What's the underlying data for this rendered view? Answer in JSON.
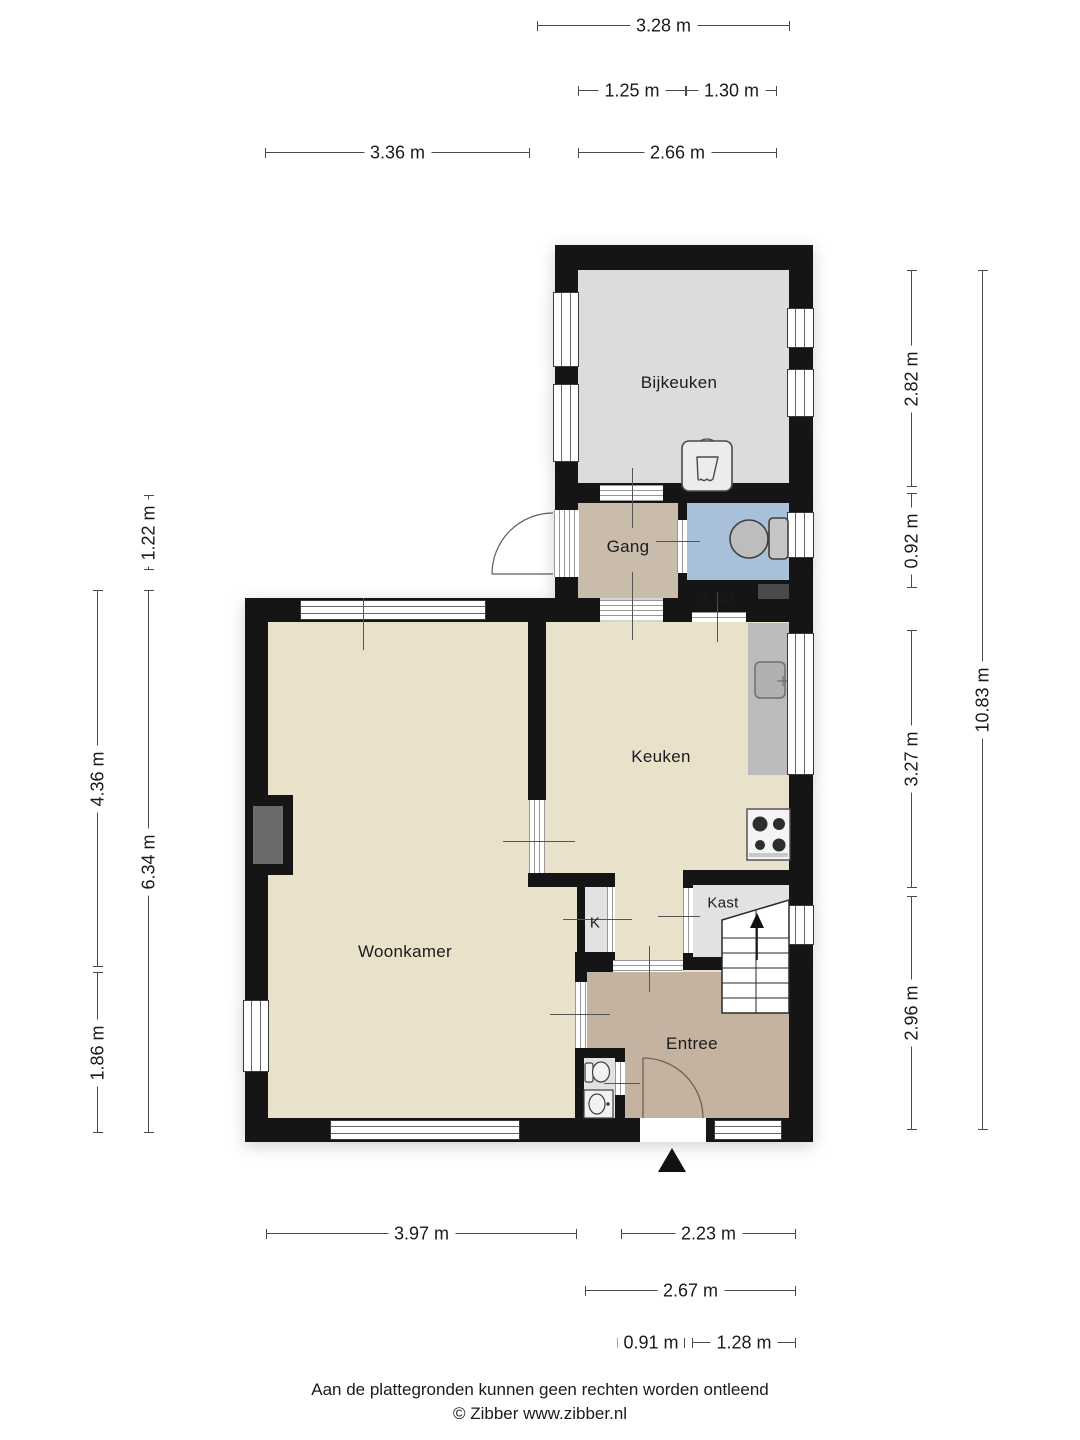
{
  "rooms": {
    "bijkeuken": "Bijkeuken",
    "gang": "Gang",
    "hall_closet": "Kast",
    "keuken": "Keuken",
    "woonkamer": "Woonkamer",
    "small_closet": "K",
    "stairs_closet": "Kast",
    "entree": "Entree"
  },
  "dimensions": {
    "top": [
      "3.28 m",
      "1.25 m",
      "1.30 m",
      "3.36 m",
      "2.66 m"
    ],
    "left": [
      "1.22 m",
      "4.36 m",
      "6.34 m",
      "1.86 m"
    ],
    "right": [
      "2.82 m",
      "0.92 m",
      "3.27 m",
      "2.96 m",
      "10.83 m"
    ],
    "bottom": [
      "3.97 m",
      "2.23 m",
      "2.67 m",
      "0.91 m",
      "1.28 m"
    ]
  },
  "footer": {
    "disclaimer": "Aan de plattegronden kunnen geen rechten worden ontleend",
    "credit": "© Zibber www.zibber.nl"
  },
  "colors": {
    "wall": "#151515",
    "bijkeuken_floor": "#dcdcdc",
    "gang_floor": "#cabcaa",
    "toilet_floor": "#a9c0da",
    "living_kitchen_floor": "#e9e1ca",
    "entree_floor": "#c4b3a1",
    "closet_floor": "#e2e2e2",
    "counter": "#bcbcbc",
    "shaft": "#4a4a4a",
    "chimney": "#6b6b6b",
    "dimension_line": "#4a4a4a"
  },
  "icons": {
    "toilet": "toilet-icon",
    "washbasin": "washbasin-icon",
    "utility_sink": "utility-sink-icon",
    "kitchen_sink": "kitchen-sink-icon",
    "stove": "stove-icon",
    "stairs": "stairs-icon",
    "doors": "door-arc-icon",
    "entrance_marker": "entrance-arrow-icon"
  }
}
